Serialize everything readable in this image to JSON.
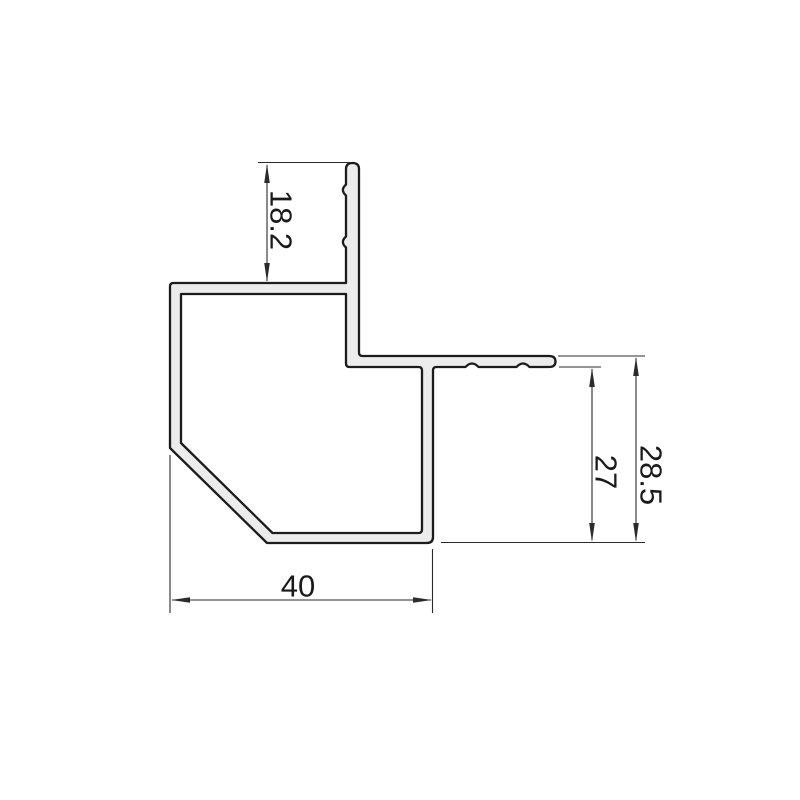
{
  "dimensions": {
    "fin_height": "18.2",
    "flange_to_base_inner": "27",
    "flange_to_base_outer": "28.5",
    "base_width": "40"
  },
  "colors": {
    "background": "#ffffff",
    "profile_fill": "#ececec",
    "profile_outline": "#1c1c1c",
    "dimension_line": "#2b2b2b",
    "label_text": "#1a1a1a"
  }
}
